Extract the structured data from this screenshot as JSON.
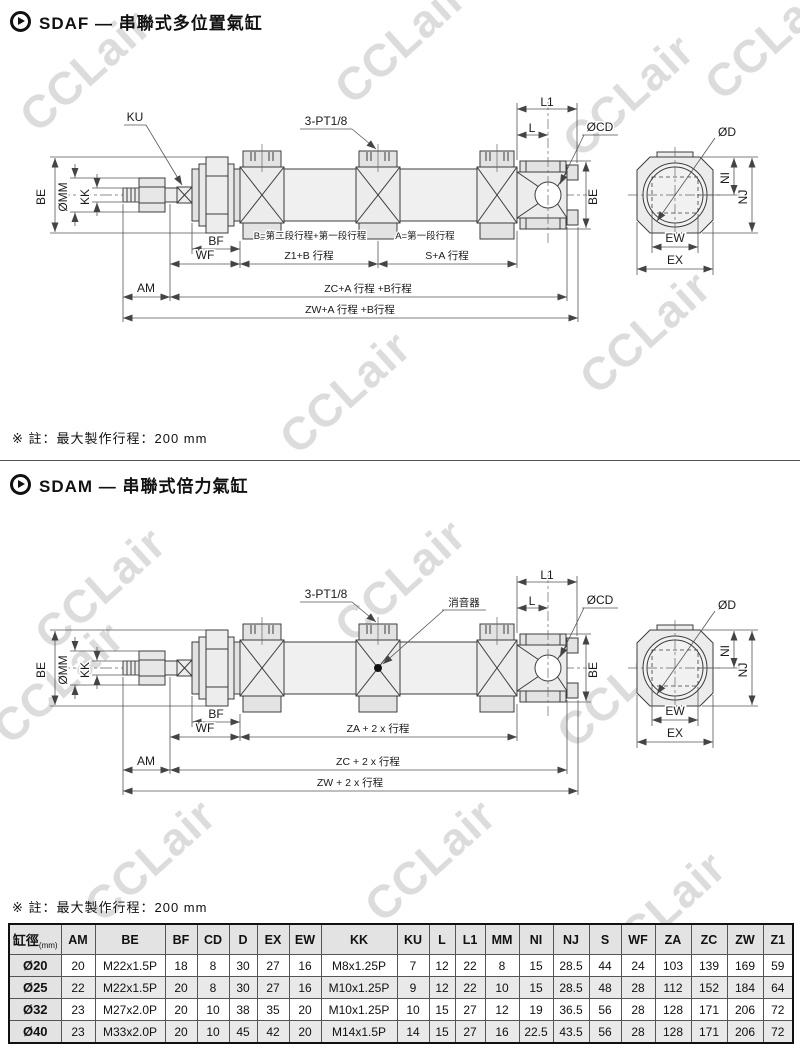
{
  "watermark": {
    "text": "CCLair",
    "color": "#dcdcdc"
  },
  "section1": {
    "title": "SDAF — 串聯式多位置氣缸",
    "note": "※ 註：最大製作行程：200 mm"
  },
  "section2": {
    "title": "SDAM — 串聯式倍力氣缸",
    "note": "※ 註：最大製作行程：200 mm"
  },
  "diagram1": {
    "labels": {
      "ku": "KU",
      "port": "3-PT1/8",
      "l1": "L1",
      "l": "L",
      "cd": "ØCD",
      "d": "ØD",
      "be_left": "BE",
      "mm": "ØMM",
      "kk": "KK",
      "be_right": "BE",
      "ni": "NI",
      "nj": "NJ",
      "ew": "EW",
      "ex": "EX",
      "bf": "BF",
      "wf": "WF",
      "am": "AM",
      "note_b": "B=第二段行程+第一段行程",
      "note_a": "A=第一段行程",
      "dim1": "Z1+B 行程",
      "dim2": "S+A 行程",
      "dim3": "ZC+A 行程 +B行程",
      "dim4": "ZW+A 行程 +B行程"
    }
  },
  "diagram2": {
    "labels": {
      "port": "3-PT1/8",
      "muffler": "消音器",
      "l1": "L1",
      "l": "L",
      "cd": "ØCD",
      "d": "ØD",
      "be_left": "BE",
      "mm": "ØMM",
      "kk": "KK",
      "be_right": "BE",
      "ni": "NI",
      "nj": "NJ",
      "ew": "EW",
      "ex": "EX",
      "bf": "BF",
      "wf": "WF",
      "am": "AM",
      "dim1": "ZA + 2 x 行程",
      "dim3": "ZC + 2 x 行程",
      "dim4": "ZW + 2 x 行程"
    }
  },
  "table": {
    "header": {
      "col0_label": "缸徑",
      "col0_sub": "(mm)",
      "columns": [
        "AM",
        "BE",
        "BF",
        "CD",
        "D",
        "EX",
        "EW",
        "KK",
        "KU",
        "L",
        "L1",
        "MM",
        "NI",
        "NJ",
        "S",
        "WF",
        "ZA",
        "ZC",
        "ZW",
        "Z1"
      ]
    },
    "rows": [
      {
        "dia": "Ø20",
        "values": [
          "20",
          "M22x1.5P",
          "18",
          "8",
          "30",
          "27",
          "16",
          "M8x1.25P",
          "7",
          "12",
          "22",
          "8",
          "15",
          "28.5",
          "44",
          "24",
          "103",
          "139",
          "169",
          "59"
        ]
      },
      {
        "dia": "Ø25",
        "values": [
          "22",
          "M22x1.5P",
          "20",
          "8",
          "30",
          "27",
          "16",
          "M10x1.25P",
          "9",
          "12",
          "22",
          "10",
          "15",
          "28.5",
          "48",
          "28",
          "112",
          "152",
          "184",
          "64"
        ]
      },
      {
        "dia": "Ø32",
        "values": [
          "23",
          "M27x2.0P",
          "20",
          "10",
          "38",
          "35",
          "20",
          "M10x1.25P",
          "10",
          "15",
          "27",
          "12",
          "19",
          "36.5",
          "56",
          "28",
          "128",
          "171",
          "206",
          "72"
        ]
      },
      {
        "dia": "Ø40",
        "values": [
          "23",
          "M33x2.0P",
          "20",
          "10",
          "45",
          "42",
          "20",
          "M14x1.5P",
          "14",
          "15",
          "27",
          "16",
          "22.5",
          "43.5",
          "56",
          "28",
          "128",
          "171",
          "206",
          "72"
        ]
      }
    ]
  }
}
